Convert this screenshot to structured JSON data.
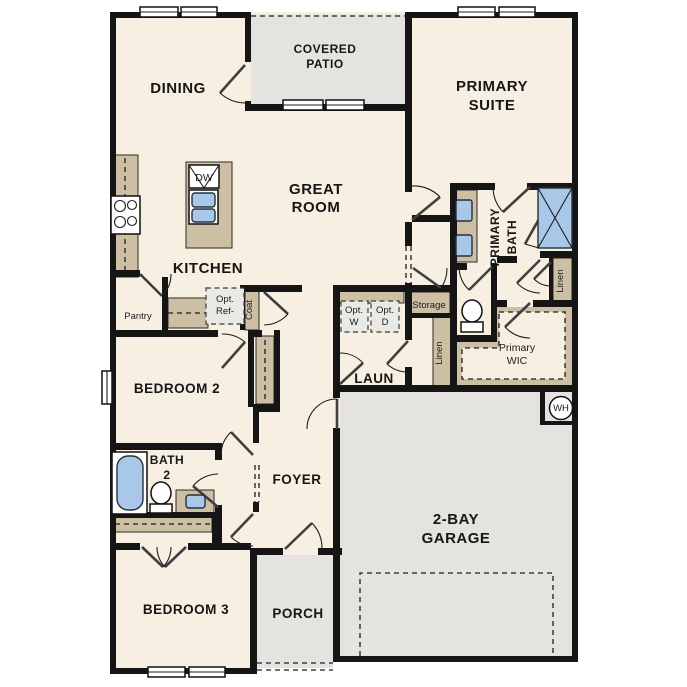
{
  "colors": {
    "wall": "#151515",
    "floor": "#f7efe1",
    "outdoor": "#e4e3e0",
    "cabinet": "#ccbfa4",
    "blue": "#a9c8e9",
    "optbox": "#e9e9e5"
  },
  "rooms": {
    "dining": "DINING",
    "covered_patio": [
      "COVERED",
      "PATIO"
    ],
    "primary_suite": [
      "PRIMARY",
      "SUITE"
    ],
    "great_room": [
      "GREAT",
      "ROOM"
    ],
    "kitchen": "KITCHEN",
    "primary_bath": [
      "PRIMARY",
      "BATH"
    ],
    "primary_wic": [
      "Primary",
      "WIC"
    ],
    "laundry": "LAUN",
    "bedroom2": "BEDROOM 2",
    "bath2": [
      "BATH",
      "2"
    ],
    "foyer": "FOYER",
    "bedroom3": "BEDROOM 3",
    "porch": "PORCH",
    "garage": [
      "2-BAY",
      "GARAGE"
    ]
  },
  "features": {
    "pantry": "Pantry",
    "opt_ref": [
      "Opt.",
      "Ref-"
    ],
    "coat": "Coat",
    "dishwasher": "DW",
    "storage": "Storage",
    "linen_hall": "Linen",
    "linen_bath": "Linen",
    "opt_washer": [
      "Opt.",
      "W"
    ],
    "opt_dryer": [
      "Opt.",
      "D"
    ],
    "water_heater": "WH"
  }
}
